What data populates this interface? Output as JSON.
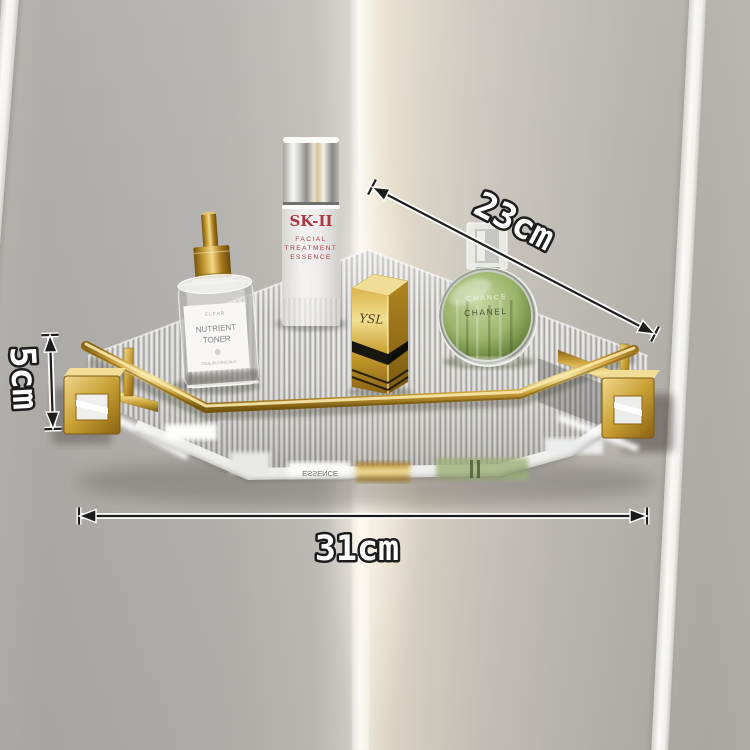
{
  "annotations": {
    "depth": "23cm",
    "height": "5cm",
    "width": "31cm"
  },
  "products": {
    "toner": {
      "line1": "CLEAR",
      "line2": "NUTRIENT",
      "line3": "TONER",
      "line4": "TRUE BOTANICALS"
    },
    "skii": {
      "brand": "SK-II",
      "line1": "FACIAL",
      "line2": "TREATMENT",
      "line3": "ESSENCE"
    },
    "lipstick": {
      "brand": "YSL"
    },
    "perfume": {
      "line1": "CHANCE",
      "line2": "CHANEL"
    }
  },
  "shelf": {
    "reflection_text": "ESSENCE"
  },
  "colors": {
    "gold_accent": "#c9a13b",
    "gold_highlight": "#f6e49c",
    "wall_left": "#b2b0ac",
    "wall_right": "#cdc9c2",
    "corner_highlight": "#f8f6f1",
    "acrylic_light": "#ececea",
    "acrylic_dark": "#93928f",
    "skii_text_red": "#a93844",
    "perfume_green": "#8aa55e",
    "lipstick_black": "#17160f",
    "dimension_text_fill": "#ffffff",
    "dimension_text_outline": "#1d1d1d"
  }
}
